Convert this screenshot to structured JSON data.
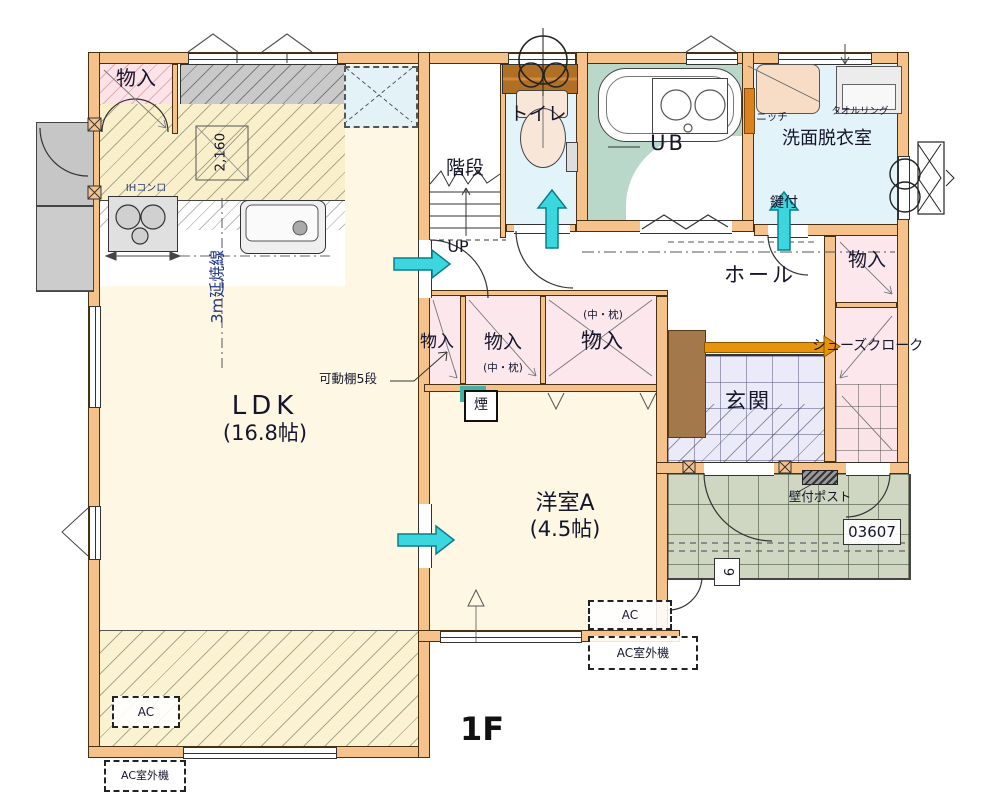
{
  "floor": {
    "label": "1F"
  },
  "rooms": {
    "ldk": {
      "name": "LDK",
      "size": "(16.8帖)"
    },
    "western_a": {
      "name": "洋室A",
      "size": "(4.5帖)"
    },
    "stairs": {
      "name": "階段"
    },
    "toilet": {
      "name": "トイレ"
    },
    "bath": {
      "name": "UB"
    },
    "washroom": {
      "name": "洗面脱衣室"
    },
    "hall": {
      "name": "ホール"
    },
    "entrance": {
      "name": "玄関"
    },
    "storage": {
      "name": "物入"
    },
    "shoes_cloak": {
      "name": "シューズクローク"
    }
  },
  "annotations": {
    "up": "UP",
    "niche": "ニッチ",
    "towel_ring": "タオルリング",
    "lock": "鍵付",
    "ih_stove": "IHコンロ",
    "dim_2160": "2,160",
    "fire_spread_line": "3m延焼線",
    "movable_shelf": "可動棚5段",
    "naka_makura": "(中・枕)",
    "smoke": "煙",
    "ac": "AC",
    "ac_outdoor": "AC室外機",
    "wall_post": "壁付ポスト",
    "plan_number": "03607",
    "step_nine": "9"
  },
  "colors": {
    "wall": "#f5c28c",
    "flow_arrow": "#3bd6de",
    "handrail": "#e8930c",
    "bath_floor": "#b9d8ca",
    "porch_floor": "#cfd6c2"
  }
}
